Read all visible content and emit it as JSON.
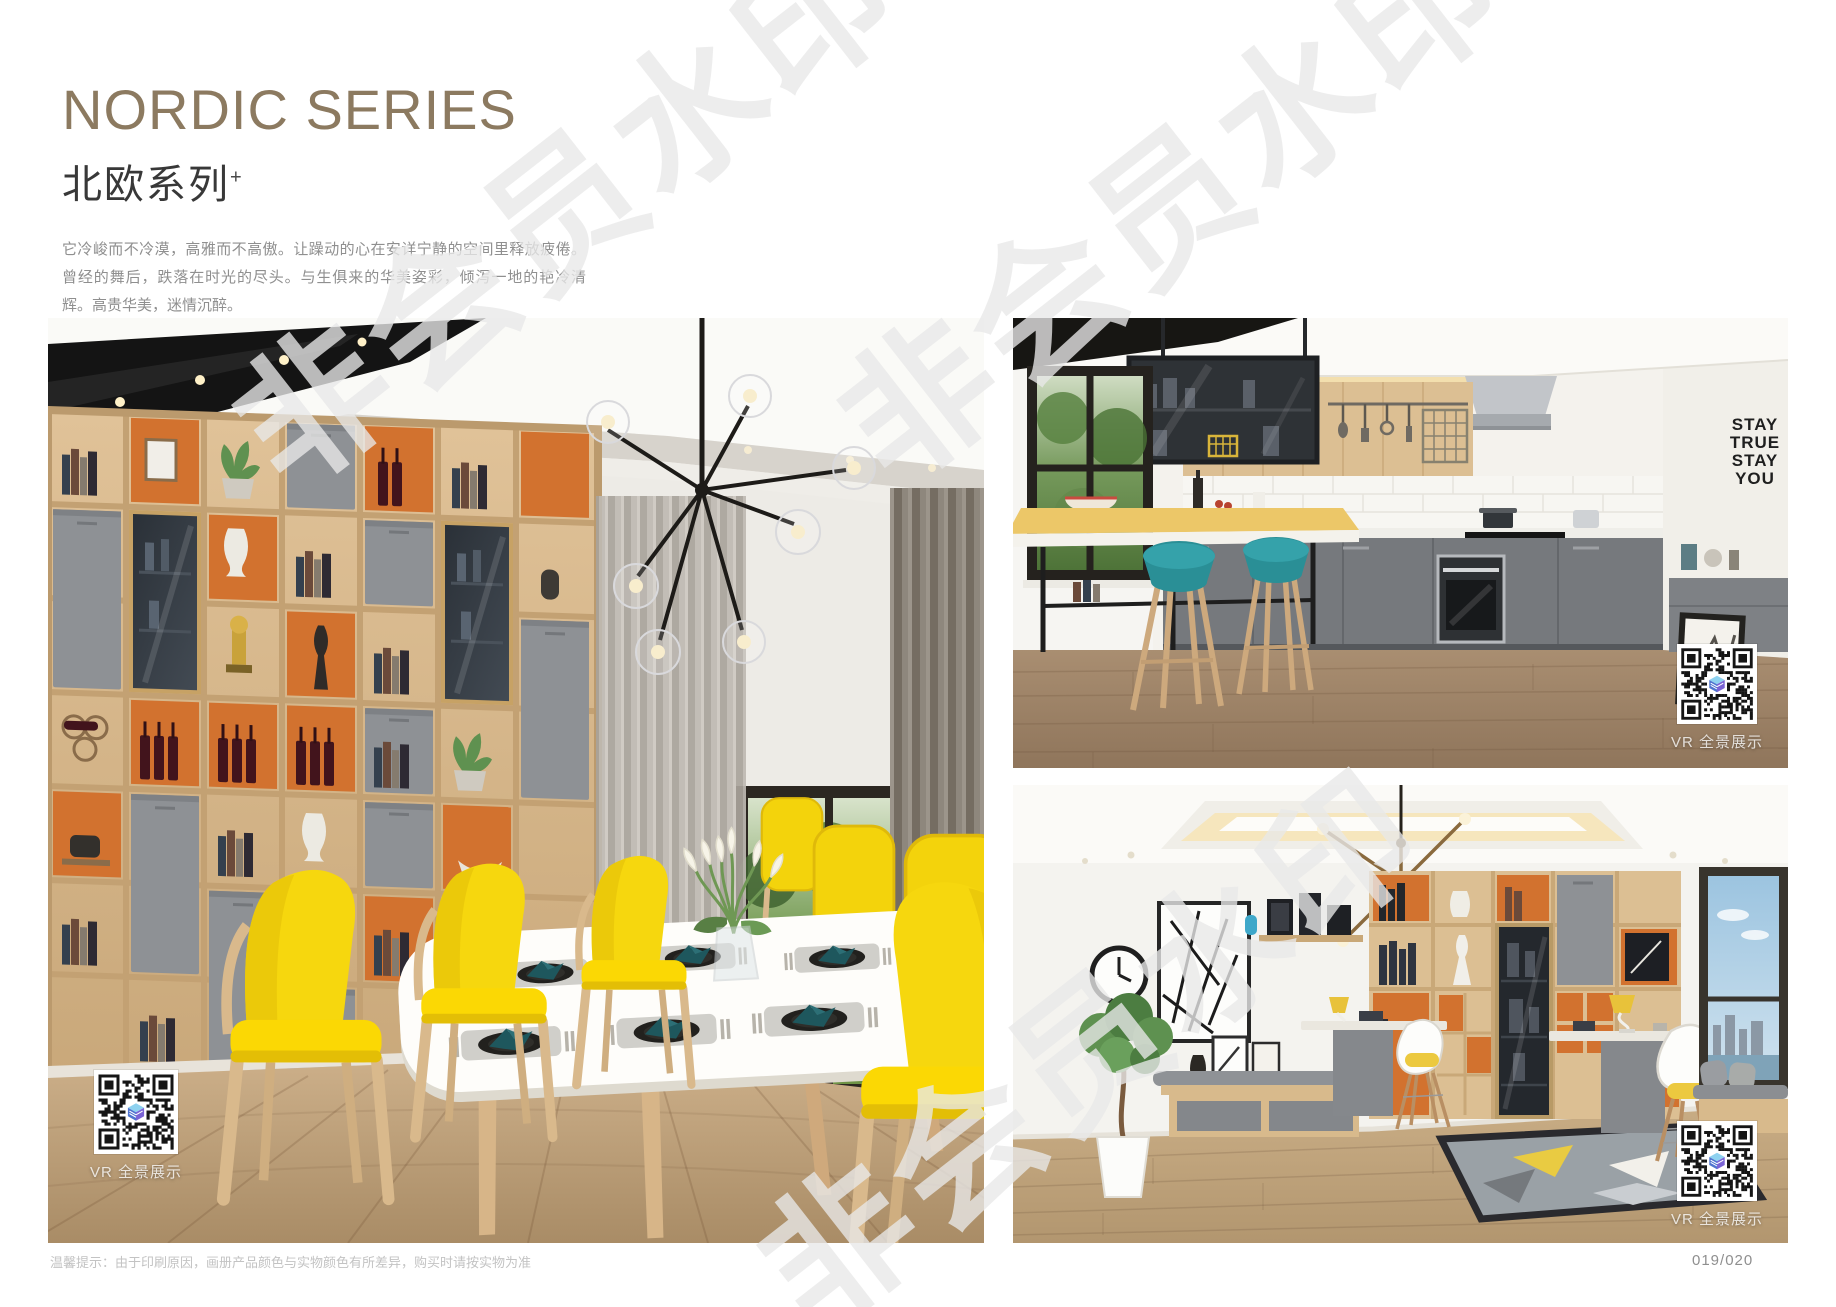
{
  "page": {
    "title": "NORDIC SERIES",
    "subtitle": "北欧系列",
    "subtitle_mark": "+",
    "desc_cn": "它冷峻而不冷漠，高雅而不高傲。让躁动的心在安详宁静的空间里释放疲倦。曾经的舞后，跌落在时光的尽头。与生俱来的华美姿彩，倾泻一地的艳冷清辉。高贵华美，迷情沉醉。",
    "desc_en": "It is cold but not cold, elegant but not haughty. Let the restless heart in the space of peace and tranquility release fatigue. Once the Queen of Dance, fall in the end of time. The natural beauty of the beautiful, pouring a land of cold and pure brilliance. Noble, beautiful, enchanted.",
    "footer_note": "温馨提示：由于印刷原因，画册产品颜色与实物颜色有所差异，购买时请按实物为准",
    "page_number": "019/020"
  },
  "watermark": {
    "text": "非会员水印"
  },
  "photos": {
    "dining": {
      "vr_label": "VR 全景展示"
    },
    "kitchen": {
      "vr_label": "VR 全景展示",
      "wall_lines": [
        "STAY",
        "TRUE",
        "STAY",
        "YOU"
      ]
    },
    "study": {
      "vr_label": "VR 全景展示"
    }
  },
  "colors": {
    "title_brown": "#8c7a60",
    "accent_yellow": "#f6d70e",
    "accent_orange": "#d2722f",
    "accent_teal": "#2a8f96",
    "cabinet_gray": "#8e9195",
    "wood": "#dcbf93"
  }
}
